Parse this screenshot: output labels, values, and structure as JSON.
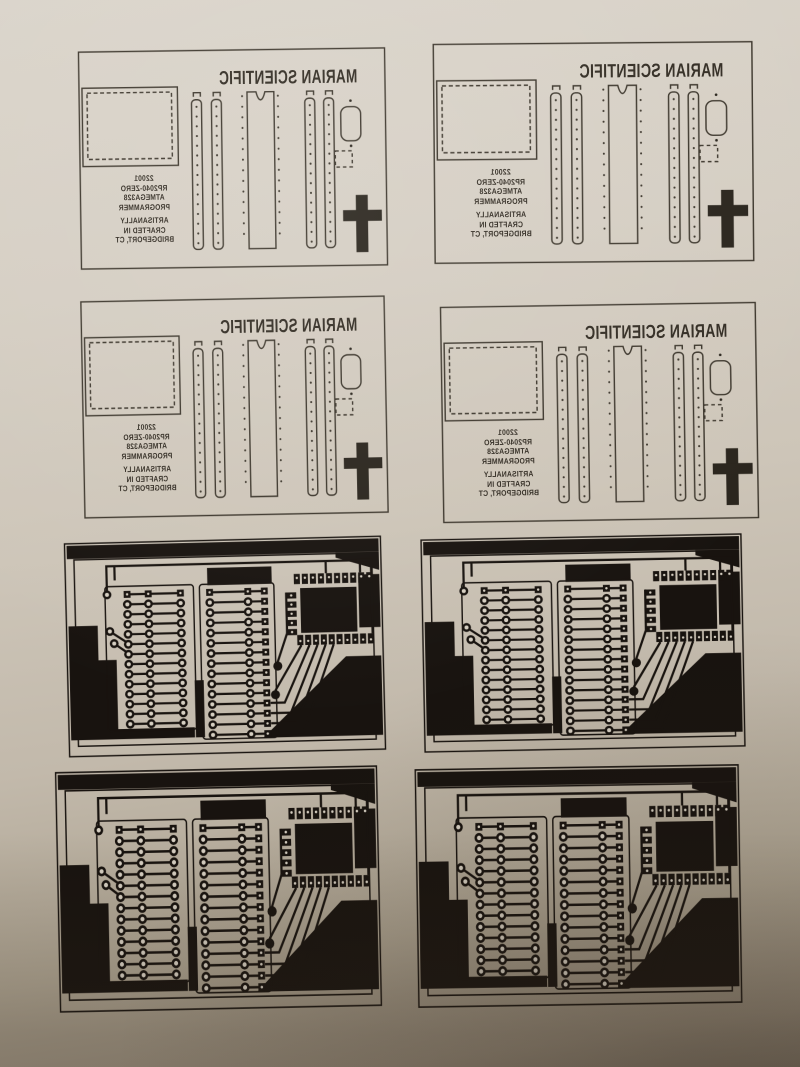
{
  "sheet": {
    "columns": 2,
    "rows": 4,
    "silkscreen_copies": 4,
    "copper_copies": 4
  },
  "silkscreen": {
    "title": "MARIAN SCIENTIFIC",
    "text_mirrored": true,
    "part_lines": [
      "22001",
      "RP2040-ZERO",
      "ATMEGA328",
      "PROGRAMMER"
    ],
    "crafted_lines": [
      "ARTISANALLY",
      "CRAFTED IN",
      "BRIDGEPORT, CT"
    ],
    "header_pin_dots": 15,
    "dip_pins_per_side": 15
  },
  "copper": {
    "structure": {
      "left_rows": 14,
      "middle_rows": 15,
      "module_top_pads": 10,
      "module_side_pads": 5,
      "module_bottom_pads": 10,
      "fan_traces": 6,
      "filled_round_pads": 2
    }
  },
  "colors": {
    "paper_light": "#dad4ca",
    "paper_mid": "#cdc5b8",
    "paper_dark": "#938878",
    "paper_deep": "#7e7466",
    "copper_ink": "#18130f",
    "silk_ink": "#3d372d"
  }
}
